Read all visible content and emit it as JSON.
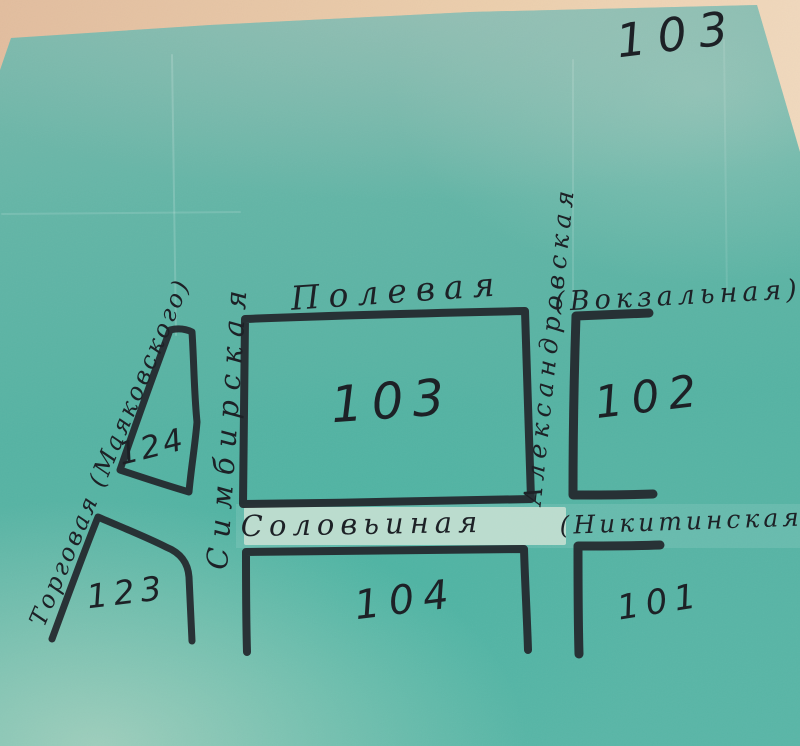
{
  "page": {
    "number": "103"
  },
  "palette": {
    "paper_tan": "#ecCFad",
    "sheet_teal": "#58b4a5",
    "ink": "#23262b",
    "patch": "#d8e7da"
  },
  "streets": {
    "polevaya": {
      "label": "Полевая"
    },
    "vokzalnaya": {
      "label": "(Вокзальная)"
    },
    "simbirskaya": {
      "label": "Симбирская"
    },
    "aleksandrovskaya": {
      "label": "Александровская"
    },
    "solovinaya": {
      "label": "Соловьиная"
    },
    "nikitinskaya": {
      "label": "(Никитинская)"
    },
    "torgovaya": {
      "label": "Торговая (Маяковского)"
    }
  },
  "blocks": {
    "b103": {
      "label": "103"
    },
    "b102": {
      "label": "102"
    },
    "b104": {
      "label": "104"
    },
    "b101": {
      "label": "101"
    },
    "b123": {
      "label": "123"
    },
    "b124": {
      "label": "124"
    }
  }
}
